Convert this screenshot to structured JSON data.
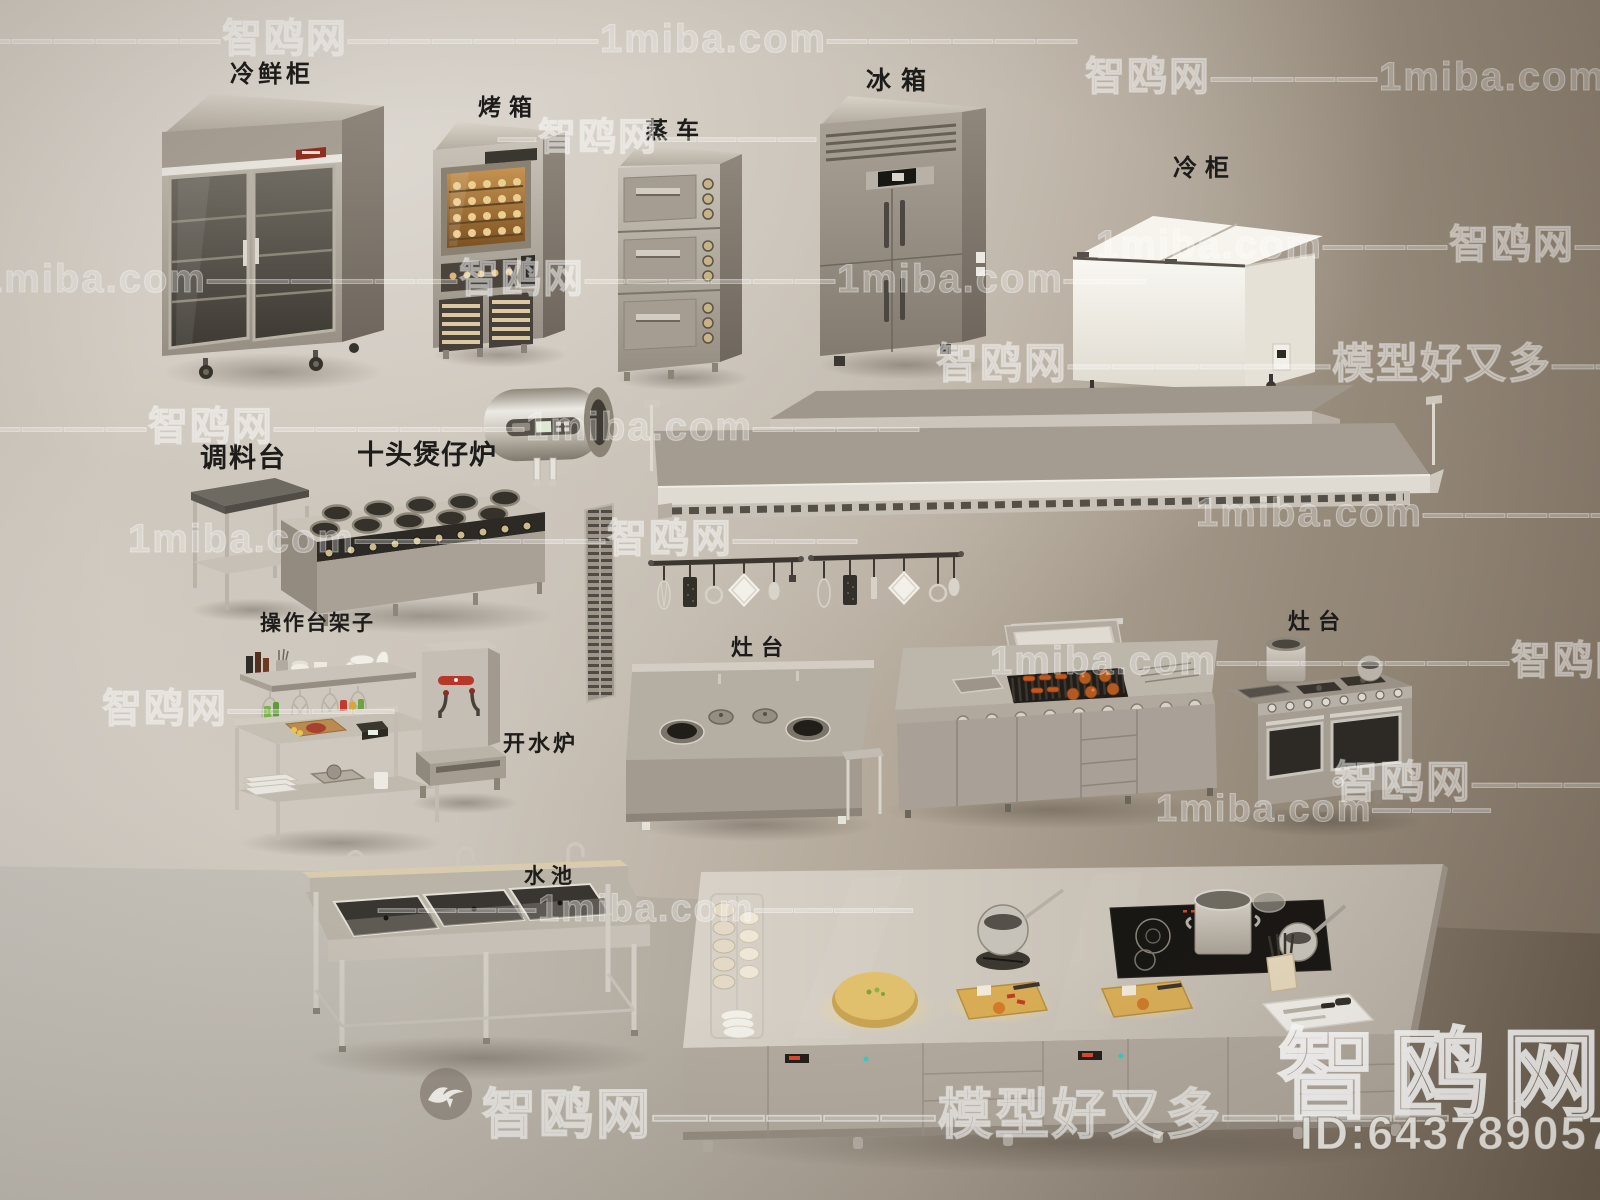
{
  "scene_type": "3d-commercial-kitchen-equipment-model-preview",
  "labels": {
    "fresh_cabinet": "冷鲜柜",
    "oven": "烤箱",
    "steam_cart": "蒸车",
    "fridge": "冰箱",
    "freezer": "冷柜",
    "seasoning_table": "调料台",
    "ten_head_stove": "十头煲仔炉",
    "worktable_shelf": "操作台架子",
    "water_boiler": "开水炉",
    "stove_left": "灶台",
    "stove_right": "灶台",
    "sink": "水池"
  },
  "watermarks": {
    "row_top": "——————智鸥网——————1miba.com——————",
    "row_top_right": "智鸥网————1miba.com————",
    "row2_left": "1miba.com——————智鸥网——————1miba.com——",
    "row2_right": "1miba.com———智鸥网—————",
    "row_mid_steam": "—智鸥网————",
    "row3_right": "智鸥网——————模型好又多—————",
    "row4_left": "————智鸥网——————1miba.com————",
    "row5_left": "1miba.com——————智鸥网———",
    "row5_right": "1miba.com———————智鸥网——",
    "row6_right": "1miba.com———————智鸥网",
    "row7_left": "智鸥网————",
    "row8_right": "智鸥网———",
    "row9_sink": "————1miba.com————",
    "row10_right": "1miba.com———",
    "footer": "智鸥网—————模型好又多————",
    "brand": "智鸥网",
    "model_id": "ID:643789057"
  },
  "colors": {
    "wall_light": "#d7d2cb",
    "wall_dark": "#7f7263",
    "floor_light": "#cdc9c2",
    "floor_dark": "#685c4e",
    "steel_light": "#c8c2b8",
    "steel_dark": "#968e82",
    "label_text": "#1d1c1a",
    "watermark": "#ffffff",
    "led_red": "#d64a30",
    "led_teal": "#3cc8c4",
    "board_glow": "#e9c77a",
    "sausage_orange": "#c2561c"
  }
}
